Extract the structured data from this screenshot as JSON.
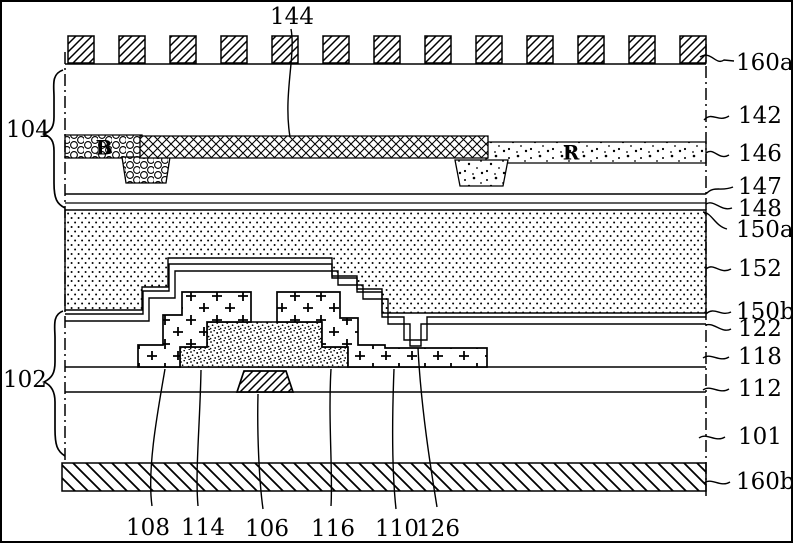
{
  "colors": {
    "ink": "#000000",
    "paper": "#ffffff"
  },
  "labels": {
    "top": [
      "144"
    ],
    "left": [
      "104",
      "102"
    ],
    "right": [
      "160a",
      "142",
      "146",
      "147",
      "148",
      "150a",
      "152",
      "150b",
      "122",
      "118",
      "112",
      "101",
      "160b"
    ],
    "bottom": [
      "108",
      "114",
      "106",
      "116",
      "110",
      "126"
    ],
    "letters": [
      "B",
      "R"
    ]
  }
}
